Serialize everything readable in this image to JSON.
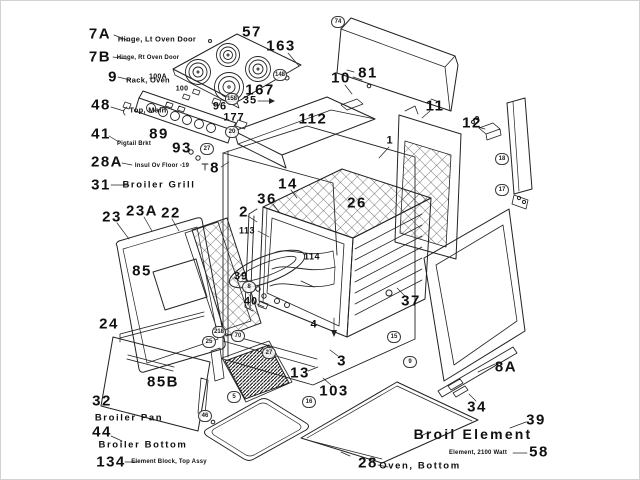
{
  "colors": {
    "ink": "#1a1a1a",
    "paper": "#ffffff"
  },
  "callouts": [
    {
      "num": "7A",
      "x": 99,
      "y": 33,
      "kind": "lg",
      "label": "Hinge, Lt Oven Door",
      "label_x": 156,
      "label_y": 38,
      "label_kind": "sm"
    },
    {
      "num": "7B",
      "x": 99,
      "y": 56,
      "kind": "lg",
      "label": "Hinge, Rt Oven Door",
      "label_x": 147,
      "label_y": 57,
      "label_kind": "xs"
    },
    {
      "num": "9",
      "x": 112,
      "y": 76,
      "kind": "lg",
      "label": "Rack, Oven",
      "label_x": 147,
      "label_y": 79,
      "label_kind": "sm"
    },
    {
      "num": "48",
      "x": 100,
      "y": 104,
      "kind": "lg",
      "label": "Top, Main",
      "label_x": 147,
      "label_y": 109,
      "label_kind": "sm"
    },
    {
      "num": "41",
      "x": 100,
      "y": 133,
      "kind": "lg",
      "label": "Pigtail Brkt",
      "label_x": 133,
      "label_y": 143,
      "label_kind": "xs"
    },
    {
      "num": "28A",
      "x": 106,
      "y": 161,
      "kind": "lg",
      "label": "Insul Ov Floor -19",
      "label_x": 161,
      "label_y": 165,
      "label_kind": "xs"
    },
    {
      "num": "31",
      "x": 100,
      "y": 184,
      "kind": "lg",
      "label": "Broiler Grill",
      "label_x": 158,
      "label_y": 184,
      "label_kind": "md"
    },
    {
      "num": "57",
      "x": 251,
      "y": 31,
      "kind": "lg"
    },
    {
      "num": "163",
      "x": 280,
      "y": 45,
      "kind": "lg"
    },
    {
      "num": "10",
      "x": 340,
      "y": 77,
      "kind": "lg"
    },
    {
      "num": "81",
      "x": 367,
      "y": 72,
      "kind": "lg"
    },
    {
      "num": "112",
      "x": 312,
      "y": 118,
      "kind": "lg"
    },
    {
      "num": "11",
      "x": 434,
      "y": 105,
      "kind": "lg"
    },
    {
      "num": "12",
      "x": 471,
      "y": 122,
      "kind": "lg"
    },
    {
      "num": "100A",
      "x": 157,
      "y": 76,
      "kind": "xs"
    },
    {
      "num": "100",
      "x": 181,
      "y": 88,
      "kind": "xs"
    },
    {
      "num": "167",
      "x": 259,
      "y": 89,
      "kind": "lg"
    },
    {
      "num": "35",
      "x": 249,
      "y": 100,
      "kind": "md"
    },
    {
      "num": "96",
      "x": 219,
      "y": 106,
      "kind": "md"
    },
    {
      "num": "177",
      "x": 233,
      "y": 117,
      "kind": "md"
    },
    {
      "num": "89",
      "x": 158,
      "y": 133,
      "kind": "lg"
    },
    {
      "num": "93",
      "x": 181,
      "y": 147,
      "kind": "lg"
    },
    {
      "num": "8",
      "x": 214,
      "y": 167,
      "kind": "lg"
    },
    {
      "num": "14",
      "x": 287,
      "y": 183,
      "kind": "lg"
    },
    {
      "num": "36",
      "x": 266,
      "y": 198,
      "kind": "lg"
    },
    {
      "num": "26",
      "x": 356,
      "y": 202,
      "kind": "lg"
    },
    {
      "num": "1",
      "x": 389,
      "y": 140,
      "kind": "md"
    },
    {
      "num": "2",
      "x": 243,
      "y": 211,
      "kind": "lg"
    },
    {
      "num": "113",
      "x": 246,
      "y": 230,
      "kind": "sm"
    },
    {
      "num": "23",
      "x": 111,
      "y": 216,
      "kind": "lg"
    },
    {
      "num": "23A",
      "x": 141,
      "y": 210,
      "kind": "lg"
    },
    {
      "num": "22",
      "x": 170,
      "y": 212,
      "kind": "lg"
    },
    {
      "num": "85",
      "x": 141,
      "y": 270,
      "kind": "lg"
    },
    {
      "num": "24",
      "x": 108,
      "y": 323,
      "kind": "lg"
    },
    {
      "num": "39",
      "x": 240,
      "y": 276,
      "kind": "md"
    },
    {
      "num": "40",
      "x": 250,
      "y": 301,
      "kind": "md"
    },
    {
      "num": "114",
      "x": 311,
      "y": 256,
      "kind": "sm"
    },
    {
      "num": "37",
      "x": 410,
      "y": 300,
      "kind": "lg"
    },
    {
      "num": "4",
      "x": 313,
      "y": 324,
      "kind": "md"
    },
    {
      "num": "3",
      "x": 341,
      "y": 360,
      "kind": "lg"
    },
    {
      "num": "13",
      "x": 299,
      "y": 372,
      "kind": "lg"
    },
    {
      "num": "103",
      "x": 333,
      "y": 390,
      "kind": "lg"
    },
    {
      "num": "85B",
      "x": 162,
      "y": 381,
      "kind": "lg"
    },
    {
      "num": "32",
      "x": 101,
      "y": 400,
      "kind": "lg",
      "label": "Broiler Pan",
      "label_x": 128,
      "label_y": 417,
      "label_kind": "md"
    },
    {
      "num": "44",
      "x": 101,
      "y": 431,
      "kind": "lg",
      "label": "Broiler Bottom",
      "label_x": 142,
      "label_y": 444,
      "label_kind": "md"
    },
    {
      "num": "134",
      "x": 110,
      "y": 461,
      "kind": "lg",
      "label": "Element Block, Top Assy",
      "label_x": 168,
      "label_y": 461,
      "label_kind": "xs"
    },
    {
      "num": "8A",
      "x": 505,
      "y": 366,
      "kind": "lg"
    },
    {
      "num": "34",
      "x": 476,
      "y": 406,
      "kind": "lg"
    },
    {
      "num": "39",
      "x": 535,
      "y": 419,
      "kind": "lg",
      "label": "Broil Element",
      "label_x": 472,
      "label_y": 433,
      "label_kind": "lg2"
    },
    {
      "num": "58",
      "x": 538,
      "y": 451,
      "kind": "lg",
      "label": "Element, 2100 Watt",
      "label_x": 477,
      "label_y": 452,
      "label_kind": "xs"
    },
    {
      "num": "28",
      "x": 367,
      "y": 462,
      "kind": "lg",
      "label": "Oven, Bottom",
      "label_x": 419,
      "label_y": 465,
      "label_kind": "md"
    }
  ],
  "circled": [
    {
      "num": "74",
      "x": 337,
      "y": 21
    },
    {
      "num": "148",
      "x": 279,
      "y": 74
    },
    {
      "num": "158",
      "x": 231,
      "y": 98
    },
    {
      "num": "20",
      "x": 231,
      "y": 131
    },
    {
      "num": "27",
      "x": 206,
      "y": 148
    },
    {
      "num": "18",
      "x": 501,
      "y": 158
    },
    {
      "num": "17",
      "x": 501,
      "y": 189
    },
    {
      "num": "8",
      "x": 248,
      "y": 286
    },
    {
      "num": "218",
      "x": 218,
      "y": 331
    },
    {
      "num": "25",
      "x": 208,
      "y": 341
    },
    {
      "num": "70",
      "x": 237,
      "y": 335
    },
    {
      "num": "27",
      "x": 268,
      "y": 352
    },
    {
      "num": "5",
      "x": 233,
      "y": 396
    },
    {
      "num": "46",
      "x": 204,
      "y": 415
    },
    {
      "num": "15",
      "x": 393,
      "y": 336
    },
    {
      "num": "9",
      "x": 409,
      "y": 361
    },
    {
      "num": "16",
      "x": 308,
      "y": 401
    }
  ]
}
